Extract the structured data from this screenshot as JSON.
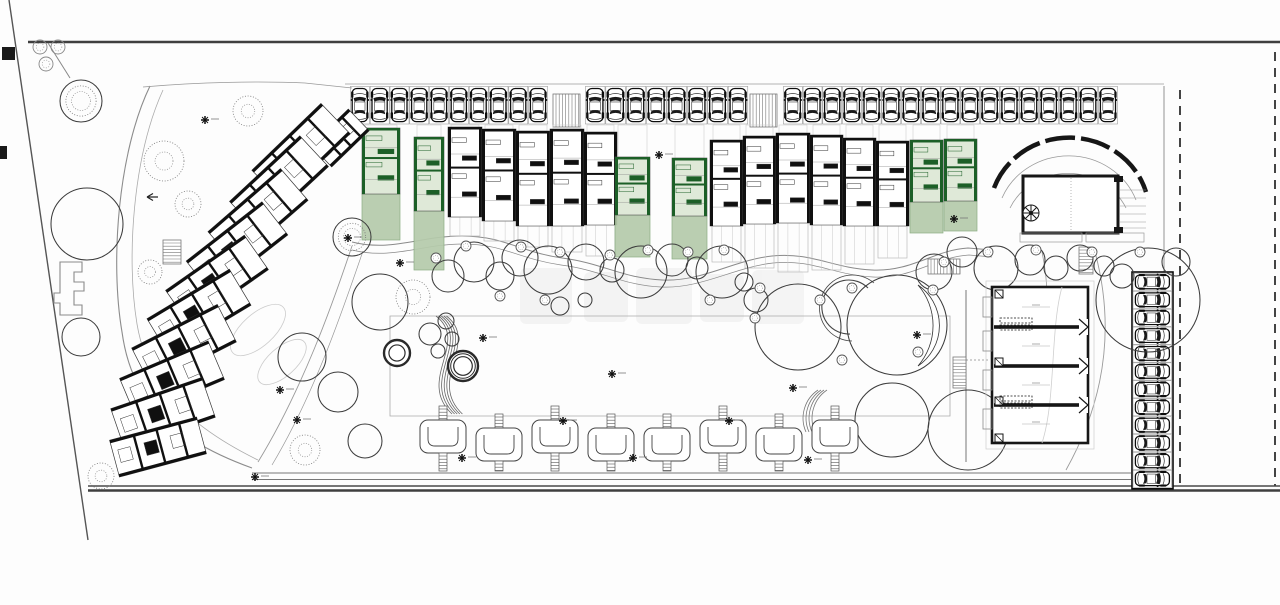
{
  "plan": {
    "kind": "residential-site-plan",
    "highlight_note": "green-units-highlighted",
    "colors": {
      "ink": "#161616",
      "wall": "#101010",
      "gray": "#8c8c8c",
      "lightgray": "#c2c2c2",
      "road": "#3f3f3f",
      "green_wall": "#1c5f27",
      "green_body": "#dfe9d8",
      "garden": "#b5cbab",
      "garden_edge": "#82a77a",
      "bg": "#fdfdfd"
    },
    "boundary_paths": [
      {
        "d": "M28,42 H1280",
        "s": "#3f3f3f",
        "w": 2.4
      },
      {
        "d": "M9,0 L88,540",
        "s": "#555555",
        "w": 1.4
      },
      {
        "d": "M48,43 L70,78",
        "s": "#888888",
        "w": 1
      },
      {
        "d": "M150,86 C118,152 110,262 122,332 C129,382 152,432 252,468",
        "s": "#8c8c8c",
        "w": 1.1
      },
      {
        "d": "M163,90 C133,156 126,258 137,324 C145,372 172,418 258,460",
        "s": "#ababab",
        "w": 0.8
      },
      {
        "d": "M352,246 C332,306 302,390 258,462",
        "s": "#999999",
        "w": 0.9
      },
      {
        "d": "M363,251 C343,309 315,393 272,465",
        "s": "#999999",
        "w": 0.7
      },
      {
        "d": "M352,242 C392,252 420,236 462,236 C504,236 520,252 562,258 C602,263 622,278 662,280 C702,282 734,260 772,256 C812,252 832,268 872,270 C912,272 934,250 968,248 L992,250",
        "s": "#8a8a8a",
        "w": 1
      },
      {
        "d": "M352,250 C392,260 422,244 463,244 C503,244 519,259 561,265 C601,270 621,285 661,287 C701,289 735,267 773,263 C813,259 833,275 873,277 C913,279 935,257 969,255 L992,257",
        "s": "#8a8a8a",
        "w": 0.7
      },
      {
        "d": "M390,316 H950 V416 H390 Z",
        "s": "#aaaaaa",
        "w": 0.8
      },
      {
        "d": "M1164,86 V486",
        "s": "#888888",
        "w": 0.9
      },
      {
        "d": "M345,84 H1164",
        "s": "#999999",
        "w": 0.8
      },
      {
        "d": "M143,87 C200,82 260,81 305,83 L352,88",
        "s": "#999999",
        "w": 0.8
      },
      {
        "d": "M1180,90 V486",
        "s": "#161616",
        "w": 1.6,
        "da": "9,7"
      },
      {
        "d": "M1275,52 V486",
        "s": "#161616",
        "w": 1.6,
        "da": "9,7"
      },
      {
        "d": "M252,473 H1131",
        "s": "#777777",
        "w": 1
      },
      {
        "d": "M252,479.5 H1131",
        "s": "#777777",
        "w": 1
      },
      {
        "d": "M88,486 H1280",
        "s": "#4a4a4a",
        "w": 1.4
      },
      {
        "d": "M88,490.5 H1280",
        "s": "#3f3f3f",
        "w": 2.6
      },
      {
        "d": "M966,290 V462",
        "s": "#777777",
        "w": 1
      },
      {
        "d": "M1095,252 C1116,330 1104,402 1066,470",
        "s": "#9a9a9a",
        "w": 0.9
      },
      {
        "d": "M1042,252 C1052,300 1046,330 1028,352",
        "s": "#9a9a9a",
        "w": 0.8
      },
      {
        "d": "M868,288 A27,27 0 1 0 850,334",
        "s": "#444444",
        "w": 1.1
      },
      {
        "d": "M874,283 A33,33 0 1 0 852,341",
        "s": "#444444",
        "w": 0.8
      },
      {
        "d": "M918,285 A49,49 0 0 1 918,366 A62,62 0 0 0 918,285 Z",
        "s": "#333333",
        "w": 0.8,
        "f": "#ffffff"
      },
      {
        "d": "M966,360 H990",
        "s": "#888888",
        "w": 0.8,
        "da": "2,2"
      },
      {
        "d": "M158,197 L147,197 M147,197 l6,-3.5 M147,197 l6,3.5",
        "s": "#222222",
        "w": 1.2
      }
    ],
    "edge_markers": [
      [
        2,
        47,
        13,
        13
      ],
      [
        0,
        146,
        7,
        13
      ]
    ],
    "corner_bushes": [
      [
        40,
        47,
        7
      ],
      [
        58,
        47,
        7
      ],
      [
        46,
        64,
        7
      ]
    ],
    "s_curve": {
      "d": "M436,316 C470,342 416,380 452,414",
      "n": 5,
      "dx": 2.6,
      "s": "#666666",
      "w": 0.8
    },
    "arc_stack": {
      "d": "M806,432 A34,34 0 0 1 818,390",
      "n": 4,
      "dx": 3,
      "s": "#777777",
      "w": 0.8
    },
    "lawn_ellipses": [
      [
        258,
        330,
        34,
        16,
        -42
      ],
      [
        282,
        362,
        30,
        14,
        -42
      ]
    ],
    "parking": {
      "rows": [
        {
          "x": 350,
          "y": 86,
          "n": 10,
          "sw": 19.8,
          "sh": 38
        },
        {
          "x": 585,
          "y": 86,
          "n": 8,
          "sw": 20.4,
          "sh": 38
        },
        {
          "x": 783,
          "y": 86,
          "n": 17,
          "sw": 19.7,
          "sh": 38
        }
      ],
      "side_column": {
        "x": 1132,
        "y": 272,
        "n": 12,
        "sh": 17.9,
        "sw": 40
      },
      "hatches": [
        [
          553,
          94,
          27,
          33,
          "v"
        ],
        [
          750,
          94,
          27,
          33,
          "v"
        ],
        [
          928,
          259,
          32,
          15,
          "v"
        ],
        [
          163,
          240,
          18,
          24,
          "h"
        ],
        [
          953,
          357,
          13,
          31,
          "h"
        ],
        [
          1079,
          247,
          14,
          27,
          "h"
        ]
      ]
    },
    "units": [
      [
        362,
        38,
        128,
        66,
        240,
        "green"
      ],
      [
        414,
        30,
        137,
        74,
        270,
        "green"
      ],
      [
        448,
        34,
        127,
        90,
        236,
        "black"
      ],
      [
        482,
        34,
        129,
        92,
        241,
        "black"
      ],
      [
        516,
        34,
        131,
        95,
        247,
        "black"
      ],
      [
        550,
        34,
        129,
        97,
        252,
        "black"
      ],
      [
        584,
        33,
        132,
        93,
        256,
        "black"
      ],
      [
        615,
        35,
        157,
        58,
        257,
        "green"
      ],
      [
        672,
        35,
        158,
        58,
        259,
        "green"
      ],
      [
        710,
        33,
        140,
        86,
        262,
        "black"
      ],
      [
        743,
        33,
        136,
        88,
        268,
        "black"
      ],
      [
        776,
        34,
        133,
        90,
        272,
        "black"
      ],
      [
        810,
        33,
        135,
        90,
        270,
        "black"
      ],
      [
        843,
        33,
        138,
        88,
        264,
        "black"
      ],
      [
        876,
        33,
        141,
        85,
        258,
        "black"
      ],
      [
        910,
        33,
        140,
        62,
        233,
        "green"
      ],
      [
        944,
        33,
        139,
        62,
        231,
        "green"
      ]
    ],
    "left_blocks": [
      [
        340,
        138,
        -44,
        52,
        30
      ],
      [
        301,
        152,
        -44,
        96,
        42
      ],
      [
        279,
        184,
        -43,
        96,
        42
      ],
      [
        258,
        216,
        -41,
        96,
        42
      ],
      [
        237,
        248,
        -38,
        96,
        42
      ],
      [
        217,
        280,
        -35,
        96,
        42
      ],
      [
        199,
        312,
        -31,
        96,
        42
      ],
      [
        184,
        345,
        -27,
        96,
        42
      ],
      [
        172,
        379,
        -23,
        96,
        42
      ],
      [
        163,
        413,
        -19,
        96,
        42
      ],
      [
        158,
        447,
        -15,
        90,
        38
      ]
    ],
    "trees": [
      [
        380,
        302,
        28,
        "p"
      ],
      [
        413,
        297,
        17,
        "s"
      ],
      [
        430,
        334,
        11,
        "p"
      ],
      [
        446,
        321,
        8,
        "p"
      ],
      [
        452,
        339,
        7,
        "p"
      ],
      [
        438,
        351,
        7,
        "p"
      ],
      [
        397,
        353,
        13,
        "r2"
      ],
      [
        463,
        366,
        15,
        "r3"
      ],
      [
        448,
        276,
        16,
        "p"
      ],
      [
        474,
        262,
        20,
        "p"
      ],
      [
        500,
        276,
        14,
        "p"
      ],
      [
        520,
        258,
        18,
        "p"
      ],
      [
        548,
        270,
        24,
        "p"
      ],
      [
        586,
        262,
        18,
        "p"
      ],
      [
        612,
        270,
        12,
        "p"
      ],
      [
        641,
        272,
        26,
        "p"
      ],
      [
        672,
        260,
        16,
        "p"
      ],
      [
        697,
        268,
        11,
        "p"
      ],
      [
        722,
        272,
        26,
        "p"
      ],
      [
        560,
        306,
        9,
        "p"
      ],
      [
        585,
        300,
        7,
        "p"
      ],
      [
        798,
        327,
        43,
        "p"
      ],
      [
        897,
        325,
        50,
        "p"
      ],
      [
        892,
        420,
        37,
        "p"
      ],
      [
        968,
        430,
        40,
        "p"
      ],
      [
        756,
        300,
        12,
        "p"
      ],
      [
        744,
        282,
        9,
        "p"
      ],
      [
        934,
        272,
        18,
        "p"
      ],
      [
        962,
        252,
        15,
        "p"
      ],
      [
        996,
        268,
        22,
        "p"
      ],
      [
        1030,
        260,
        15,
        "p"
      ],
      [
        1056,
        268,
        12,
        "p"
      ],
      [
        1080,
        258,
        13,
        "p"
      ],
      [
        1104,
        266,
        10,
        "p"
      ],
      [
        1148,
        300,
        52,
        "p"
      ],
      [
        1122,
        276,
        12,
        "p"
      ],
      [
        1176,
        262,
        14,
        "p"
      ],
      [
        87,
        224,
        36,
        "p"
      ],
      [
        81,
        337,
        19,
        "p"
      ],
      [
        81,
        101,
        21,
        "so"
      ],
      [
        248,
        111,
        15,
        "s"
      ],
      [
        164,
        161,
        20,
        "s"
      ],
      [
        188,
        204,
        13,
        "s"
      ],
      [
        150,
        272,
        12,
        "s"
      ],
      [
        101,
        476,
        13,
        "s"
      ],
      [
        305,
        450,
        15,
        "s"
      ],
      [
        352,
        237,
        19,
        "so"
      ],
      [
        302,
        357,
        24,
        "p"
      ],
      [
        338,
        392,
        20,
        "p"
      ],
      [
        365,
        441,
        17,
        "p"
      ]
    ],
    "pebbles": [
      [
        436,
        258
      ],
      [
        466,
        246
      ],
      [
        521,
        247
      ],
      [
        560,
        252
      ],
      [
        610,
        255
      ],
      [
        648,
        250
      ],
      [
        688,
        252
      ],
      [
        724,
        250
      ],
      [
        760,
        288
      ],
      [
        820,
        300
      ],
      [
        852,
        288
      ],
      [
        944,
        262
      ],
      [
        988,
        252
      ],
      [
        1036,
        250
      ],
      [
        1092,
        252
      ],
      [
        755,
        318
      ],
      [
        842,
        360
      ],
      [
        918,
        352
      ],
      [
        933,
        290
      ],
      [
        710,
        300
      ],
      [
        545,
        300
      ],
      [
        500,
        296
      ],
      [
        1140,
        252
      ]
    ],
    "pergolas": {
      "xs": [
        443,
        499,
        555,
        611,
        667,
        723,
        779,
        835
      ],
      "alt": [
        0,
        1,
        0,
        1,
        1,
        0,
        1,
        0
      ],
      "y_hi": 420,
      "y_lo": 428,
      "h": 33,
      "bottom": 471
    },
    "markers": [
      [
        205,
        120
      ],
      [
        348,
        238
      ],
      [
        400,
        263
      ],
      [
        483,
        338
      ],
      [
        563,
        421
      ],
      [
        612,
        374
      ],
      [
        462,
        458
      ],
      [
        633,
        458
      ],
      [
        729,
        421
      ],
      [
        808,
        460
      ],
      [
        793,
        388
      ],
      [
        917,
        335
      ],
      [
        659,
        155
      ],
      [
        954,
        219
      ],
      [
        280,
        390
      ],
      [
        297,
        420
      ],
      [
        255,
        477
      ]
    ],
    "clubhouse": {
      "arc": "M994,188 A80,76 0 0 1 1146,192",
      "inner_arcs": [
        "M1002,198 A72,68 0 0 1 1136,200",
        "M1010,208 A64,60 0 0 1 1126,208"
      ],
      "rect": [
        1023,
        176,
        95,
        57
      ],
      "fan": [
        1031,
        213,
        8
      ],
      "center_dash": "M1071,178 V231",
      "terraces": [
        [
          1020,
          233,
          62,
          9
        ],
        [
          1086,
          233,
          58,
          9
        ]
      ],
      "hatch_x": [
        1120,
        1146
      ],
      "hatch_ys": [
        190,
        198,
        206,
        214,
        222,
        228
      ],
      "flags": [
        [
          1114,
          176
        ],
        [
          1114,
          227
        ]
      ]
    },
    "row_building": {
      "x": 992,
      "y": 287,
      "w": 96,
      "h": 156,
      "dividers": [
        327,
        366,
        405
      ],
      "balconies": [
        297,
        331,
        370,
        409
      ],
      "squares": [
        290,
        358,
        397,
        434
      ],
      "plate_ys": [
        318,
        396
      ],
      "shadow_rect": [
        986,
        281,
        108,
        168
      ],
      "inner_curve": "M1062,287 C1050,330 1056,400 1042,443"
    },
    "f_building": "M60,262 h22 v10 h-8 v10 h10 v9 h-10 v14 h8 v10 h-22 v-12 h-6 v-10 h6 Z",
    "watermark_blocks": [
      [
        520,
        268,
        52,
        56
      ],
      [
        584,
        272,
        44,
        50
      ],
      [
        636,
        268,
        56,
        56
      ],
      [
        700,
        274,
        44,
        48
      ],
      [
        752,
        270,
        52,
        54
      ]
    ]
  }
}
